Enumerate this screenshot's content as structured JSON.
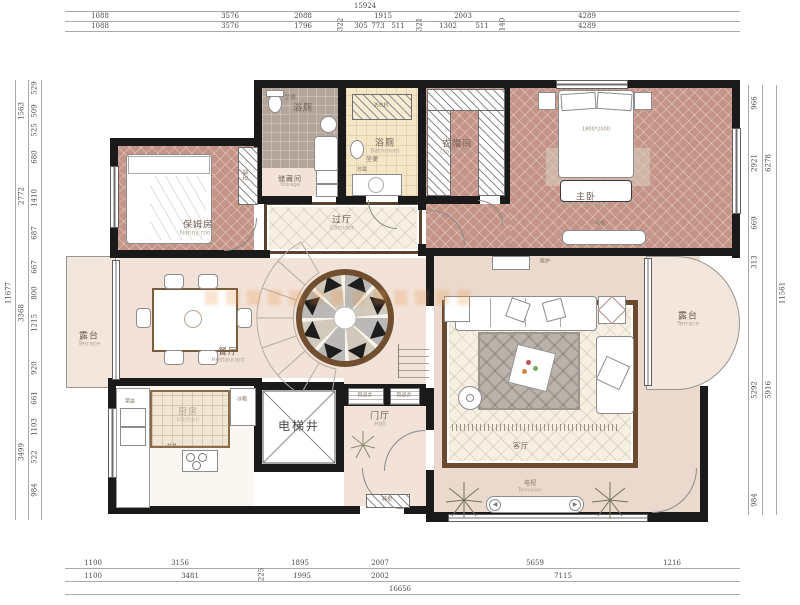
{
  "rooms": {
    "nanny": {
      "zh": "保姆房",
      "en": "Nanny room"
    },
    "bath1": {
      "zh": "浴厕",
      "en": "Bathroom"
    },
    "bath2": {
      "zh": "浴厕",
      "en": "Bathroom"
    },
    "storage": {
      "zh": "储藏间",
      "en": "Storage"
    },
    "cloak": {
      "zh": "衣帽间",
      "en": "Cloak room"
    },
    "master": {
      "zh": "主卧",
      "en": "Master bedroom"
    },
    "hallway": {
      "zh": "过厅",
      "en": "Corridor"
    },
    "dining": {
      "zh": "餐厅",
      "en": "Restaurant"
    },
    "kitchen": {
      "zh": "厨房",
      "en": "Kitchen"
    },
    "elevator": {
      "zh": "电梯井",
      "en": ""
    },
    "foyer": {
      "zh": "门厅",
      "en": "Hall"
    },
    "living": {
      "zh": "客厅",
      "en": "Living room"
    },
    "terrace_left": {
      "zh": "露台",
      "en": "Terrace"
    },
    "terrace_right": {
      "zh": "露台",
      "en": "Terrace"
    }
  },
  "furn": {
    "wardrobe": "衣柜",
    "toilet": "坐便",
    "washer": "洗衣机",
    "basin": "台盆",
    "sink": "菜盆",
    "fridge": "冰箱",
    "cooktop": "灶具",
    "tv": "电视",
    "tv_en": "Television",
    "pipe": "管道井",
    "shoe": "鞋柜",
    "fireplace": "壁炉",
    "bed_size": "1800*2000"
  },
  "dims": {
    "top": {
      "total": "15924",
      "row2": [
        "1088",
        "3576",
        "2088",
        "1915",
        "2003",
        "4289"
      ],
      "row3": [
        "1088",
        "3576",
        "1796",
        "322",
        "305",
        "773",
        "511",
        "321",
        "1302",
        "511",
        "140",
        "4289"
      ]
    },
    "bottom": {
      "row1": [
        "1100",
        "3156",
        "1895",
        "2007",
        "5659",
        "1216"
      ],
      "row2": [
        "1100",
        "3481",
        "225",
        "1995",
        "2002",
        "7115"
      ],
      "total": "16656"
    },
    "left": {
      "segments": [
        "529",
        "509",
        "525",
        "680",
        "1410",
        "687",
        "667",
        "800",
        "1215",
        "920",
        "661",
        "1103",
        "522",
        "984"
      ],
      "groups": [
        "1563",
        "2772",
        "3368",
        "3499"
      ],
      "total": "11677"
    },
    "right": {
      "segments": [
        "966",
        "2921",
        "669",
        "313",
        "5292",
        "984"
      ],
      "groups": [
        "6278",
        "5916"
      ],
      "total": "11561"
    }
  }
}
